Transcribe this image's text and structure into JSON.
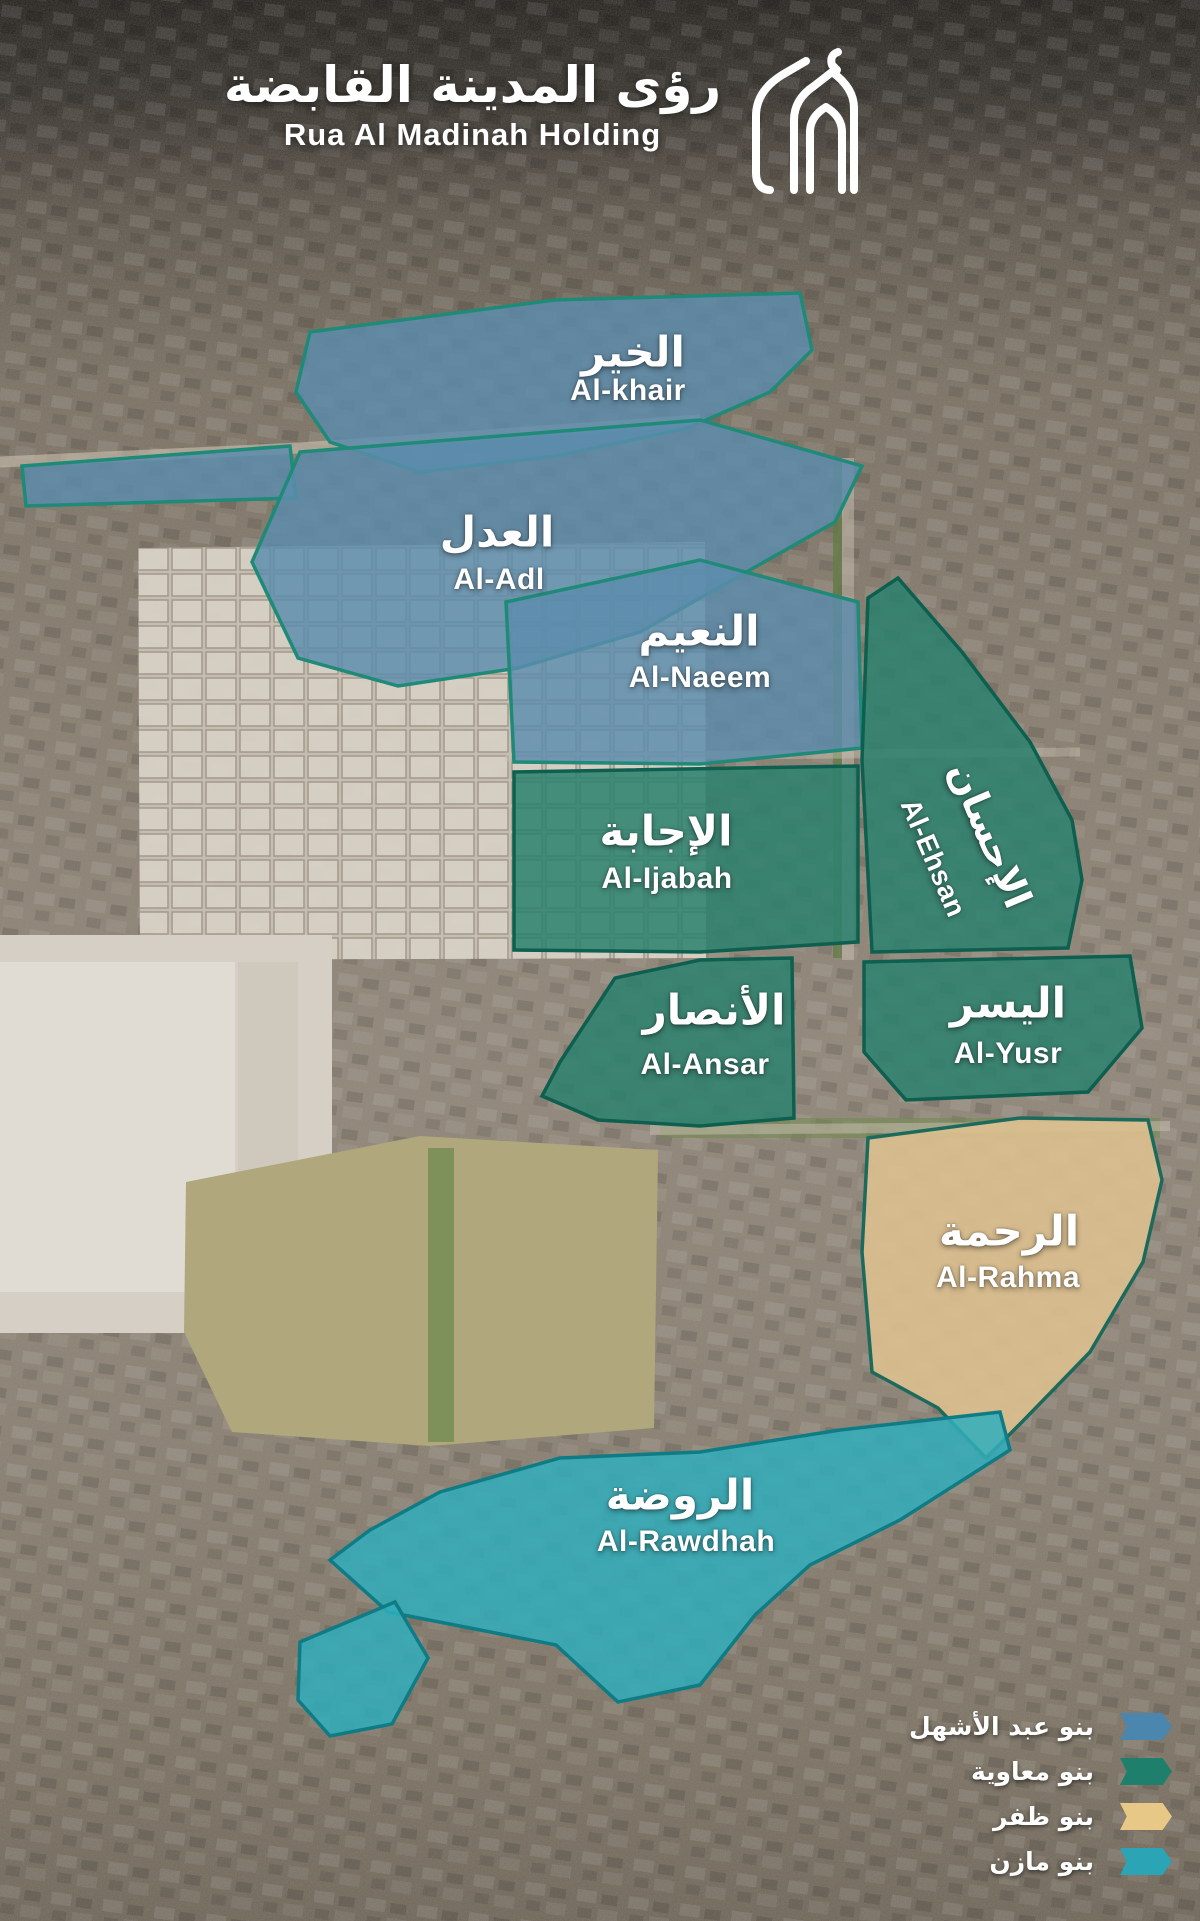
{
  "header": {
    "brand_arabic": "رؤى المدينة القابضة",
    "brand_english": "Rua Al Madinah Holding"
  },
  "districts": [
    {
      "id": "al-khair",
      "name_ar": "الخير",
      "name_en": "Al-khair",
      "color": "#5b8cad",
      "legend_group": "بنو عبد الأشهل"
    },
    {
      "id": "al-adl",
      "name_ar": "العدل",
      "name_en": "Al-Adl",
      "color": "#5b8cad",
      "legend_group": "بنو عبد الأشهل"
    },
    {
      "id": "al-naeem",
      "name_ar": "النعيم",
      "name_en": "Al-Naeem",
      "color": "#5b8cad",
      "legend_group": "بنو عبد الأشهل"
    },
    {
      "id": "al-ijabah",
      "name_ar": "الإجابة",
      "name_en": "Al-Ijabah",
      "color": "#2c816f",
      "legend_group": "بنو معاوية"
    },
    {
      "id": "al-ehsan",
      "name_ar": "الإحسان",
      "name_en": "Al-Ehsan",
      "color": "#2c816f",
      "legend_group": "بنو معاوية"
    },
    {
      "id": "al-ansar",
      "name_ar": "الأنصار",
      "name_en": "Al-Ansar",
      "color": "#2c816f",
      "legend_group": "بنو معاوية"
    },
    {
      "id": "al-yusr",
      "name_ar": "اليسر",
      "name_en": "Al-Yusr",
      "color": "#2c816f",
      "legend_group": "بنو معاوية"
    },
    {
      "id": "al-rahma",
      "name_ar": "الرحمة",
      "name_en": "Al-Rahma",
      "color": "#ddc08f",
      "legend_group": "بنو ظفر"
    },
    {
      "id": "al-rawdhah",
      "name_ar": "الروضة",
      "name_en": "Al-Rawdhah",
      "color": "#30aebc",
      "legend_group": "بنو مازن"
    }
  ],
  "legend": {
    "items": [
      {
        "label_ar": "بنو عبد الأشهل",
        "color": "#4a86ad"
      },
      {
        "label_ar": "بنو معاوية",
        "color": "#1f7f6d"
      },
      {
        "label_ar": "بنو ظفر",
        "color": "#e8c887"
      },
      {
        "label_ar": "بنو مازن",
        "color": "#2ba4b5"
      }
    ]
  }
}
